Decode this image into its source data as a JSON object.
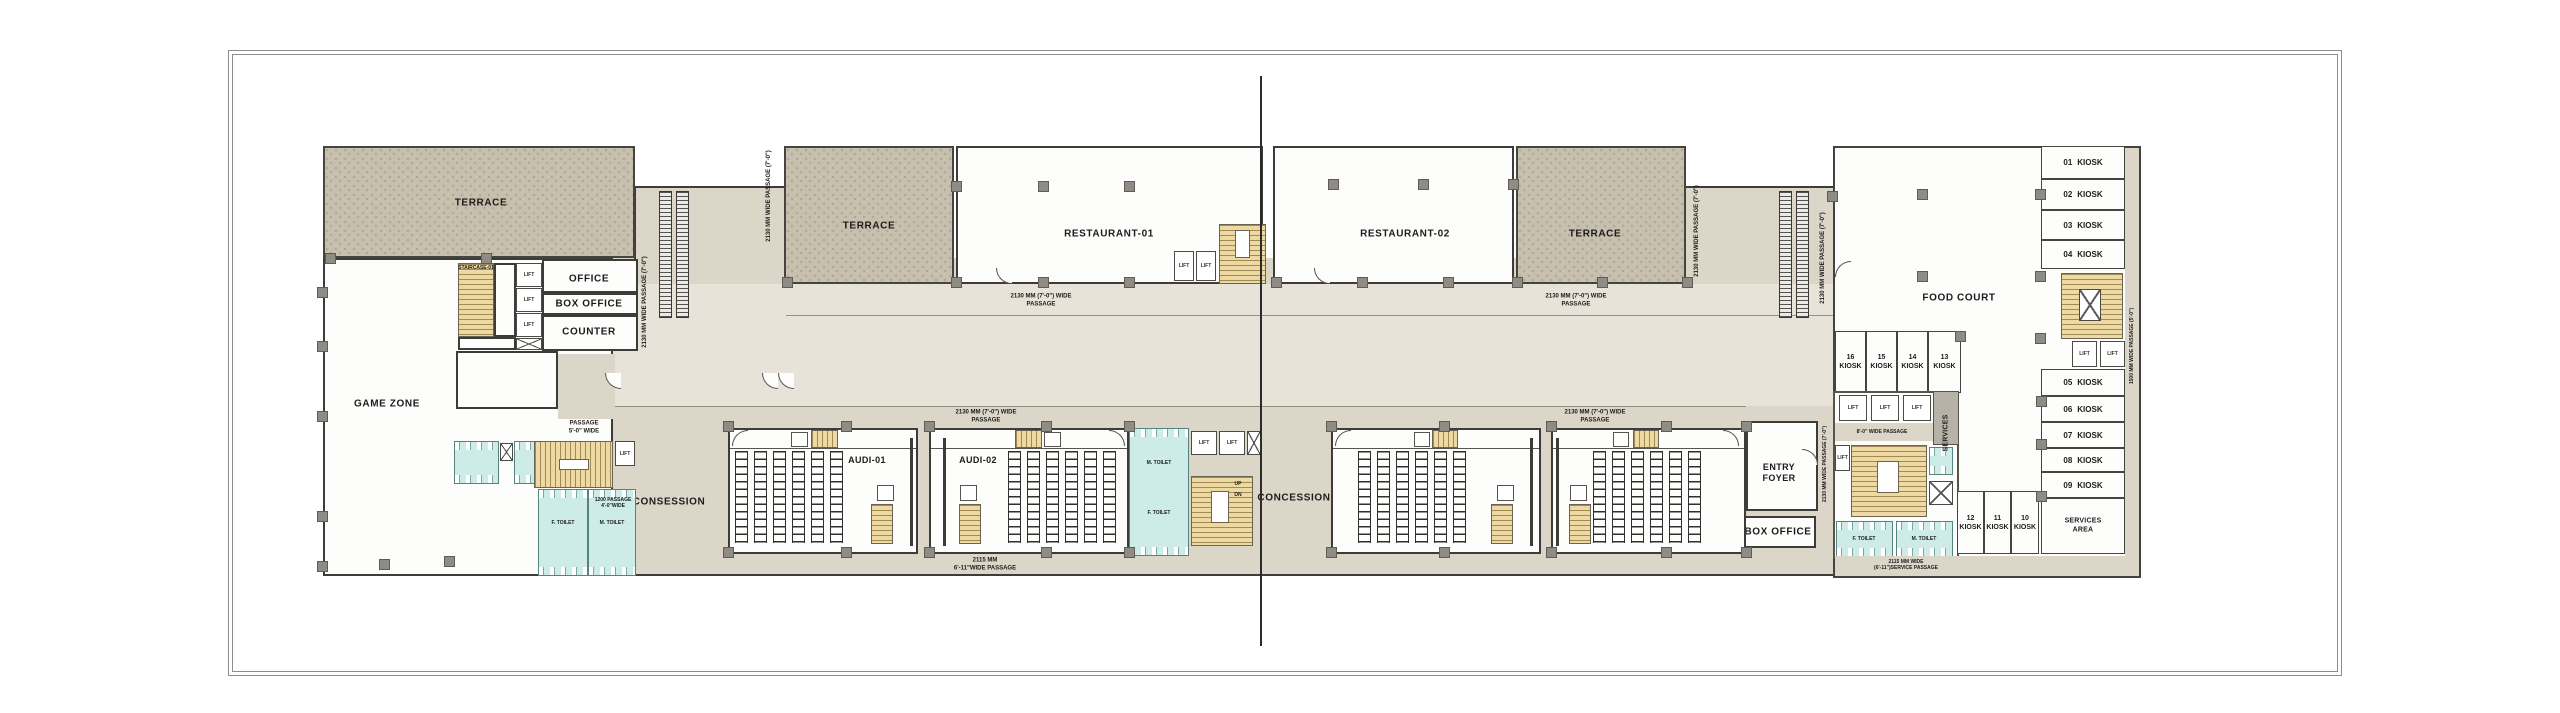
{
  "colors": {
    "passage_beige": "#dcd6c9",
    "concourse_lite": "#e8e3d8",
    "terrace_fill": "#c7c0af",
    "stair_yellow": "#eed9a2",
    "toilet_cyan": "#cdebe7",
    "wall_dark": "#3c3c3a",
    "column_gray": "#8f8c86"
  },
  "rooms": {
    "terrace": "TERRACE",
    "office": "OFFICE",
    "box_office": "BOX OFFICE",
    "counter": "COUNTER",
    "game_zone": "GAME ZONE",
    "restaurant_1": "RESTAURANT-01",
    "restaurant_2": "RESTAURANT-02",
    "food_court": "FOOD COURT",
    "audi_1": "AUDI-01",
    "audi_2": "AUDI-02",
    "entry_foyer_l1": "ENTRY",
    "entry_foyer_l2": "FOYER",
    "concession_left": "CONSESSION",
    "concession_mid": "CONCESSION",
    "services_vertical": "SERVICES",
    "services_area_l1": "SERVICES",
    "services_area_l2": "AREA",
    "staircase_1": "STAIRCASE-01",
    "lift": "LIFT",
    "up": "UP",
    "dn": "DN",
    "toilet_f": "F. TOILET",
    "toilet_m": "M. TOILET"
  },
  "passages": {
    "p2130_v": "2130 MM WIDE PASSAGE (7'-0\")",
    "p2130_h_l1": "2130 MM (7'-0\") WIDE",
    "p2130_h_l2": "PASSAGE",
    "p2115_l1": "2115 MM",
    "p2115_l2": "6'-11\"WIDE PASSAGE",
    "service_l1": "2115 MM WIDE",
    "service_l2": "(6'-11\")SERVICE PASSAGE",
    "p8ft": "8'-0\" WIDE PASSAGE",
    "p5ft_l1": "PASSAGE",
    "p5ft_l2": "5'-0\" WIDE",
    "p1200_l1": "1200 PASSAGE",
    "p1200_l2": "4'-0\"WIDE",
    "p1500_v": "1500 MM WIDE PASSAGE (5'-0\")"
  },
  "kiosks": {
    "label": "KIOSK",
    "right_column": [
      "01",
      "02",
      "03",
      "04",
      "05",
      "06",
      "07",
      "08",
      "09"
    ],
    "food_row": [
      "16",
      "15",
      "14",
      "13"
    ],
    "bottom_row": [
      "12",
      "11",
      "10"
    ]
  }
}
